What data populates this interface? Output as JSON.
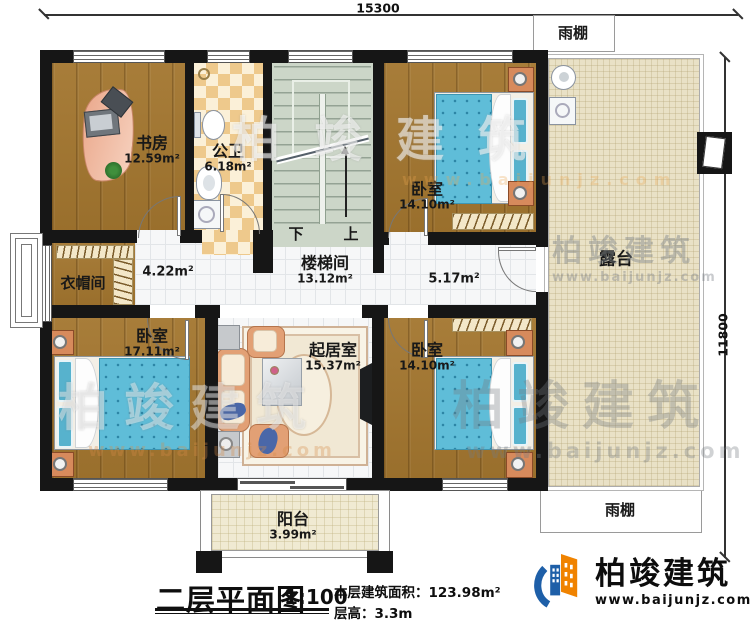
{
  "colors": {
    "brand_blue": "#1e5fa8",
    "brand_orange": "#f08300"
  },
  "dimensions": {
    "width_mm": "15300",
    "height_mm": "11800"
  },
  "stair": {
    "down": "下",
    "up": "上"
  },
  "rooms": {
    "study": {
      "name": "书房",
      "area": "12.59m²"
    },
    "bath": {
      "name": "公卫",
      "area": "6.18m²"
    },
    "stairwell": {
      "name": "楼梯间",
      "area": "13.12m²"
    },
    "bedroom_top_right": {
      "name": "卧室",
      "area": "14.10m²"
    },
    "cloakroom": {
      "name": "衣帽间"
    },
    "hall_left": {
      "area": "4.22m²"
    },
    "hall_right": {
      "area": "5.17m²"
    },
    "bedroom_bottom_left": {
      "name": "卧室",
      "area": "17.11m²"
    },
    "living_room": {
      "name": "起居室",
      "area": "15.37m²"
    },
    "bedroom_bottom_right": {
      "name": "卧室",
      "area": "14.10m²"
    },
    "terrace": {
      "name": "露台"
    },
    "balcony": {
      "name": "阳台",
      "area": "3.99m²"
    },
    "canopy_top": {
      "name": "雨棚"
    },
    "canopy_bottom": {
      "name": "雨棚"
    }
  },
  "title_block": {
    "title": "二层平面图",
    "scale": "1:100",
    "area_label": "本层建筑面积：",
    "area_value": "123.98m²",
    "height_label": "层高：",
    "height_value": "3.3m"
  },
  "brand": {
    "name": "柏竣建筑",
    "url": "www.baijunjz.com"
  },
  "watermark": {
    "name": "柏竣建筑",
    "url": "www.baijunjz.com"
  }
}
